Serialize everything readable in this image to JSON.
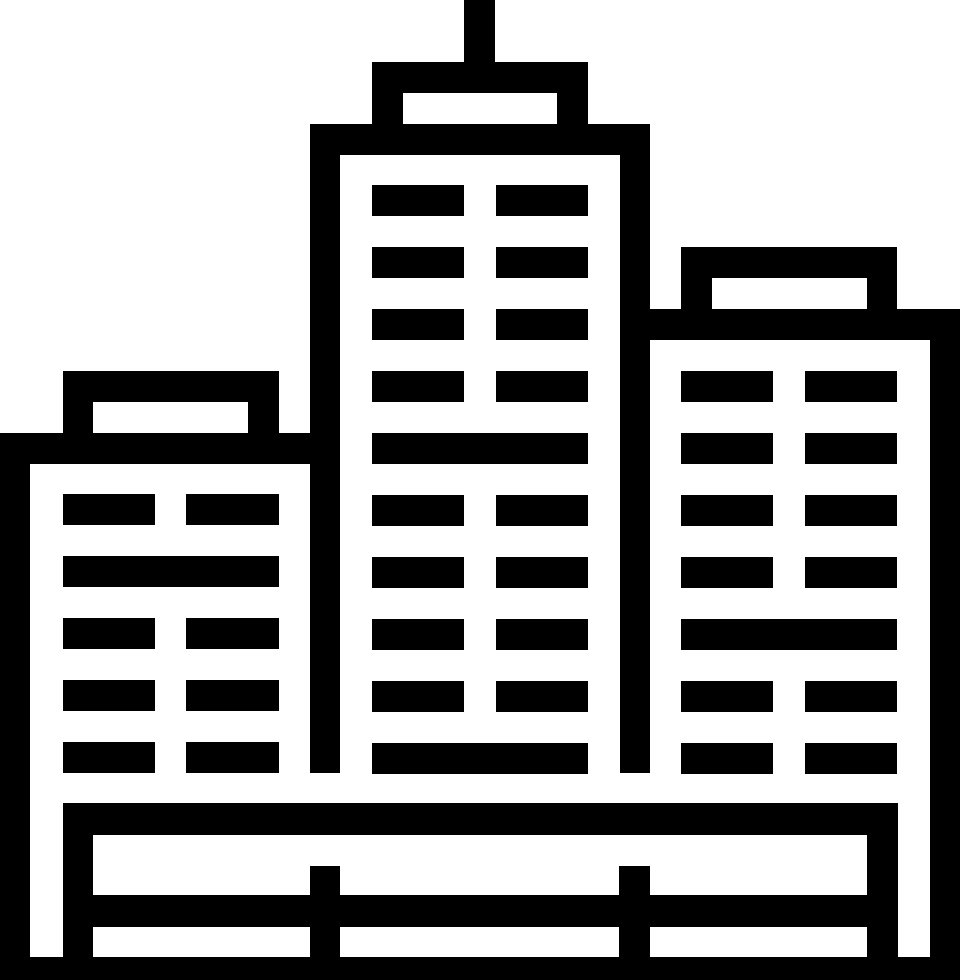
{
  "icon": {
    "name": "city-skyline",
    "viewbox": "0 0 960 980",
    "colors": {
      "foreground": "#000000",
      "background": "#ffffff"
    },
    "canvas": {
      "width": 960,
      "height": 980
    },
    "shapes": [
      {
        "name": "antenna-mast",
        "x": 464,
        "y": 0,
        "w": 31,
        "h": 62,
        "fill": "fg"
      },
      {
        "name": "center-building-cap",
        "x": 372,
        "y": 62,
        "w": 216,
        "h": 62,
        "fill": "fg"
      },
      {
        "name": "center-building-cap-window",
        "x": 403,
        "y": 93,
        "w": 154,
        "h": 31,
        "fill": "bg"
      },
      {
        "name": "center-building-roof-band",
        "x": 310,
        "y": 124,
        "w": 340,
        "h": 31,
        "fill": "fg"
      },
      {
        "name": "center-building-left-wall",
        "x": 310,
        "y": 155,
        "w": 30,
        "h": 618,
        "fill": "fg"
      },
      {
        "name": "center-building-right-wall",
        "x": 620,
        "y": 155,
        "w": 30,
        "h": 618,
        "fill": "fg"
      },
      {
        "name": "left-building-cap",
        "x": 63,
        "y": 371,
        "w": 216,
        "h": 62,
        "fill": "fg"
      },
      {
        "name": "left-building-cap-window",
        "x": 93,
        "y": 402,
        "w": 155,
        "h": 31,
        "fill": "bg"
      },
      {
        "name": "left-building-roof-band",
        "x": 0,
        "y": 433,
        "w": 310,
        "h": 31,
        "fill": "fg"
      },
      {
        "name": "left-building-outer-wall",
        "x": 0,
        "y": 463,
        "w": 30,
        "h": 517,
        "fill": "fg"
      },
      {
        "name": "right-building-cap",
        "x": 681,
        "y": 247,
        "w": 216,
        "h": 62,
        "fill": "fg"
      },
      {
        "name": "right-building-cap-window",
        "x": 712,
        "y": 278,
        "w": 155,
        "h": 31,
        "fill": "bg"
      },
      {
        "name": "right-building-roof-band",
        "x": 650,
        "y": 309,
        "w": 310,
        "h": 31,
        "fill": "fg"
      },
      {
        "name": "right-building-outer-wall",
        "x": 930,
        "y": 340,
        "w": 30,
        "h": 640,
        "fill": "fg"
      },
      {
        "name": "center-window-r1-c1",
        "x": 372,
        "y": 185,
        "w": 92,
        "h": 31,
        "fill": "fg"
      },
      {
        "name": "center-window-r1-c2",
        "x": 496,
        "y": 185,
        "w": 92,
        "h": 31,
        "fill": "fg"
      },
      {
        "name": "center-window-r2-c1",
        "x": 372,
        "y": 247,
        "w": 92,
        "h": 31,
        "fill": "fg"
      },
      {
        "name": "center-window-r2-c2",
        "x": 496,
        "y": 247,
        "w": 92,
        "h": 31,
        "fill": "fg"
      },
      {
        "name": "center-window-r3-c1",
        "x": 372,
        "y": 309,
        "w": 92,
        "h": 31,
        "fill": "fg"
      },
      {
        "name": "center-window-r3-c2",
        "x": 496,
        "y": 309,
        "w": 92,
        "h": 31,
        "fill": "fg"
      },
      {
        "name": "center-window-r4-c1",
        "x": 372,
        "y": 371,
        "w": 92,
        "h": 31,
        "fill": "fg"
      },
      {
        "name": "center-window-r4-c2",
        "x": 496,
        "y": 371,
        "w": 92,
        "h": 31,
        "fill": "fg"
      },
      {
        "name": "center-window-r5-wide",
        "x": 372,
        "y": 433,
        "w": 216,
        "h": 31,
        "fill": "fg"
      },
      {
        "name": "center-window-r6-c1",
        "x": 372,
        "y": 495,
        "w": 92,
        "h": 31,
        "fill": "fg"
      },
      {
        "name": "center-window-r6-c2",
        "x": 496,
        "y": 495,
        "w": 92,
        "h": 31,
        "fill": "fg"
      },
      {
        "name": "center-window-r7-c1",
        "x": 372,
        "y": 557,
        "w": 92,
        "h": 31,
        "fill": "fg"
      },
      {
        "name": "center-window-r7-c2",
        "x": 496,
        "y": 557,
        "w": 92,
        "h": 31,
        "fill": "fg"
      },
      {
        "name": "center-window-r8-c1",
        "x": 372,
        "y": 619,
        "w": 92,
        "h": 31,
        "fill": "fg"
      },
      {
        "name": "center-window-r8-c2",
        "x": 496,
        "y": 619,
        "w": 92,
        "h": 31,
        "fill": "fg"
      },
      {
        "name": "center-window-r9-c1",
        "x": 372,
        "y": 681,
        "w": 92,
        "h": 31,
        "fill": "fg"
      },
      {
        "name": "center-window-r9-c2",
        "x": 496,
        "y": 681,
        "w": 92,
        "h": 31,
        "fill": "fg"
      },
      {
        "name": "center-window-r10-wide",
        "x": 372,
        "y": 743,
        "w": 216,
        "h": 31,
        "fill": "fg"
      },
      {
        "name": "left-window-r1-c1",
        "x": 63,
        "y": 494,
        "w": 92,
        "h": 31,
        "fill": "fg"
      },
      {
        "name": "left-window-r1-c2",
        "x": 186,
        "y": 494,
        "w": 93,
        "h": 31,
        "fill": "fg"
      },
      {
        "name": "left-window-r2-wide",
        "x": 63,
        "y": 556,
        "w": 216,
        "h": 31,
        "fill": "fg"
      },
      {
        "name": "left-window-r3-c1",
        "x": 63,
        "y": 618,
        "w": 92,
        "h": 31,
        "fill": "fg"
      },
      {
        "name": "left-window-r3-c2",
        "x": 186,
        "y": 618,
        "w": 93,
        "h": 31,
        "fill": "fg"
      },
      {
        "name": "left-window-r4-c1",
        "x": 63,
        "y": 680,
        "w": 92,
        "h": 31,
        "fill": "fg"
      },
      {
        "name": "left-window-r4-c2",
        "x": 186,
        "y": 680,
        "w": 93,
        "h": 31,
        "fill": "fg"
      },
      {
        "name": "left-window-r5-c1",
        "x": 63,
        "y": 742,
        "w": 92,
        "h": 31,
        "fill": "fg"
      },
      {
        "name": "left-window-r5-c2",
        "x": 186,
        "y": 742,
        "w": 93,
        "h": 31,
        "fill": "fg"
      },
      {
        "name": "right-window-r1-c1",
        "x": 681,
        "y": 371,
        "w": 92,
        "h": 31,
        "fill": "fg"
      },
      {
        "name": "right-window-r1-c2",
        "x": 805,
        "y": 371,
        "w": 92,
        "h": 31,
        "fill": "fg"
      },
      {
        "name": "right-window-r2-c1",
        "x": 681,
        "y": 433,
        "w": 92,
        "h": 31,
        "fill": "fg"
      },
      {
        "name": "right-window-r2-c2",
        "x": 805,
        "y": 433,
        "w": 92,
        "h": 31,
        "fill": "fg"
      },
      {
        "name": "right-window-r3-c1",
        "x": 681,
        "y": 495,
        "w": 92,
        "h": 31,
        "fill": "fg"
      },
      {
        "name": "right-window-r3-c2",
        "x": 805,
        "y": 495,
        "w": 92,
        "h": 31,
        "fill": "fg"
      },
      {
        "name": "right-window-r4-c1",
        "x": 681,
        "y": 557,
        "w": 92,
        "h": 31,
        "fill": "fg"
      },
      {
        "name": "right-window-r4-c2",
        "x": 805,
        "y": 557,
        "w": 92,
        "h": 31,
        "fill": "fg"
      },
      {
        "name": "right-window-r5-wide",
        "x": 681,
        "y": 619,
        "w": 216,
        "h": 31,
        "fill": "fg"
      },
      {
        "name": "right-window-r6-c1",
        "x": 681,
        "y": 681,
        "w": 92,
        "h": 31,
        "fill": "fg"
      },
      {
        "name": "right-window-r6-c2",
        "x": 805,
        "y": 681,
        "w": 92,
        "h": 31,
        "fill": "fg"
      },
      {
        "name": "right-window-r7-c1",
        "x": 681,
        "y": 743,
        "w": 92,
        "h": 31,
        "fill": "fg"
      },
      {
        "name": "right-window-r7-c2",
        "x": 805,
        "y": 743,
        "w": 92,
        "h": 31,
        "fill": "fg"
      },
      {
        "name": "plaza-base-band",
        "x": 63,
        "y": 803,
        "w": 835,
        "h": 32,
        "fill": "fg"
      },
      {
        "name": "fence-left-post",
        "x": 63,
        "y": 835,
        "w": 30,
        "h": 145,
        "fill": "fg"
      },
      {
        "name": "fence-right-post",
        "x": 867,
        "y": 835,
        "w": 31,
        "h": 145,
        "fill": "fg"
      },
      {
        "name": "fence-mid-post-left",
        "x": 310,
        "y": 866,
        "w": 30,
        "h": 114,
        "fill": "fg"
      },
      {
        "name": "fence-mid-post-right",
        "x": 619,
        "y": 866,
        "w": 31,
        "h": 114,
        "fill": "fg"
      },
      {
        "name": "fence-rail",
        "x": 63,
        "y": 895,
        "w": 835,
        "h": 32,
        "fill": "fg"
      },
      {
        "name": "ground-band",
        "x": 0,
        "y": 957,
        "w": 960,
        "h": 23,
        "fill": "fg"
      }
    ]
  }
}
